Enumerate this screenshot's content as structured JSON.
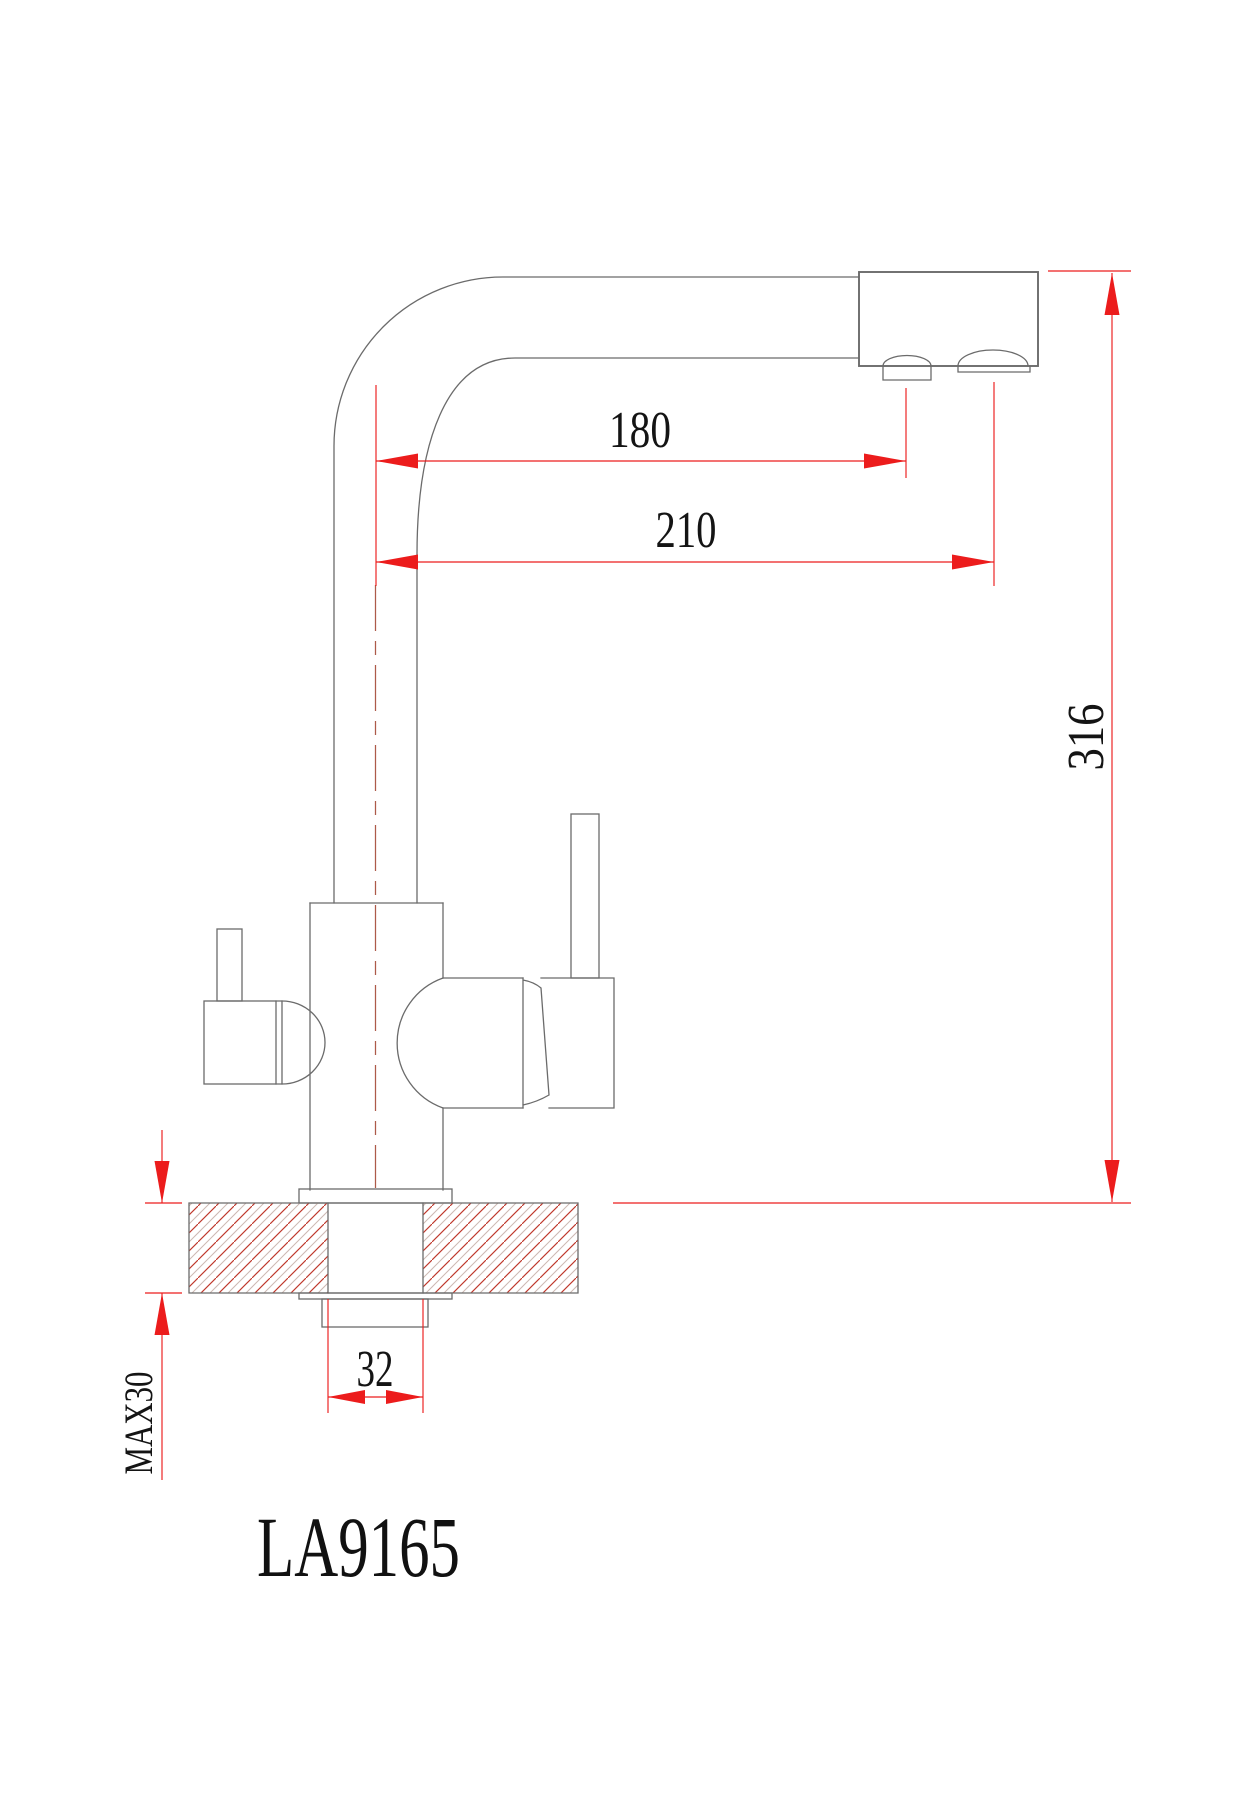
{
  "labels": {
    "model": "LA9165",
    "dim_spout_reach_inner": "180",
    "dim_spout_reach_outer": "210",
    "dim_total_height": "316",
    "dim_mount_hole": "32",
    "dim_max_counter_thickness": "MAX30"
  },
  "colors": {
    "background": "#ffffff",
    "dimension_red": "#ec1c1c",
    "outline_gray": "#6b6b6b",
    "centerline_red": "#ad5a49",
    "hatch_red": "#bf382c",
    "hatch_light": "#ccb8b2"
  }
}
